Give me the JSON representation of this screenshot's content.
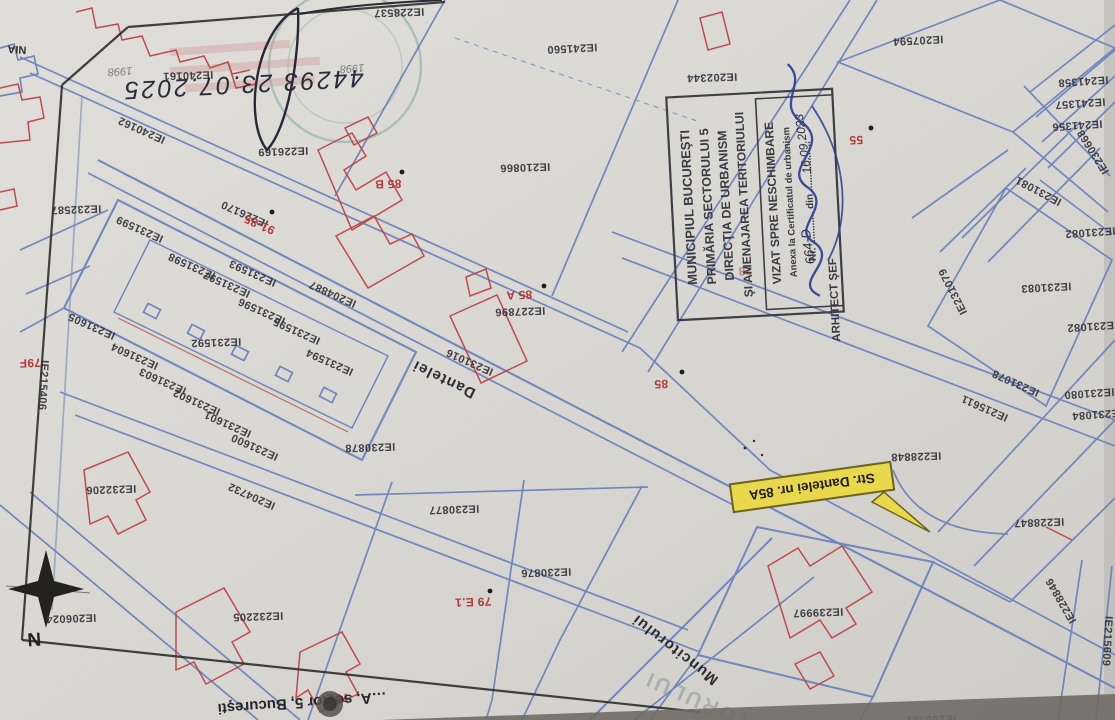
{
  "corner": {
    "text": "NIA"
  },
  "handwriting": {
    "registration": "44293   23.07.2025"
  },
  "faded": {
    "year_left": "1998",
    "year_right": "1998",
    "street_fragment": "TORULUI"
  },
  "compass": {
    "label": "N"
  },
  "footer": {
    "caption": "…A, sector 5, Bucureşti"
  },
  "callout": {
    "text": "Str. Dantelei nr. 85A",
    "fill": "#e9d84b"
  },
  "streets": {
    "dantelei": "Dantelei",
    "muncitorului": "Muncitorului"
  },
  "stamp": {
    "line1": "MUNICIPIUL BUCUREŞTI",
    "line2": "PRIMĂRIA SECTORULUI 5",
    "line3": "DIRECŢIA DE URBANISM",
    "line4": "ŞI AMENAJAREA TERITORIULUI",
    "box_title": "VIZAT SPRE NESCHIMBARE",
    "box_subtitle": "Anexa la Certificatul de urbanism",
    "number_line": "Nr. ............  din ..................",
    "handwritten_number": "664-D",
    "handwritten_date": "16.09.2023",
    "signer_title": "ARHITECT ŞEF"
  },
  "red_labels": [
    {
      "text": "85 B"
    },
    {
      "text": "85 A"
    },
    {
      "text": "85"
    },
    {
      "text": "55"
    },
    {
      "text": "91-85"
    },
    {
      "text": "79F"
    },
    {
      "text": "79 E.1"
    },
    {
      "text": "79E"
    },
    {
      "text": "28"
    }
  ],
  "parcel_ids": [
    {
      "id": "IE240161"
    },
    {
      "id": "IE240162"
    },
    {
      "id": "IE226169"
    },
    {
      "id": "IE228537"
    },
    {
      "id": "IE241560"
    },
    {
      "id": "IE202344"
    },
    {
      "id": "IE207594"
    },
    {
      "id": "IE241358"
    },
    {
      "id": "IE241357"
    },
    {
      "id": "IE241356"
    },
    {
      "id": "IE230668"
    },
    {
      "id": "IE231081"
    },
    {
      "id": "IE231082"
    },
    {
      "id": "IE231083"
    },
    {
      "id": "IE231082"
    },
    {
      "id": "IE231079"
    },
    {
      "id": "IE231078"
    },
    {
      "id": "IE215611"
    },
    {
      "id": "IE231080"
    },
    {
      "id": "IE231084"
    },
    {
      "id": "IE232587"
    },
    {
      "id": "IE226170"
    },
    {
      "id": "IE231599"
    },
    {
      "id": "IE231598"
    },
    {
      "id": "IE231597"
    },
    {
      "id": "IE231593"
    },
    {
      "id": "IE204887"
    },
    {
      "id": "IE231596"
    },
    {
      "id": "IE231595"
    },
    {
      "id": "IE231592"
    },
    {
      "id": "IE231594"
    },
    {
      "id": "IE231605"
    },
    {
      "id": "IE231604"
    },
    {
      "id": "IE231603"
    },
    {
      "id": "IE231602"
    },
    {
      "id": "IE231601"
    },
    {
      "id": "IE231600"
    },
    {
      "id": "IE215406"
    },
    {
      "id": "IE231016"
    },
    {
      "id": "IE227896"
    },
    {
      "id": "IE210866"
    },
    {
      "id": "IE230878"
    },
    {
      "id": "IE204732"
    },
    {
      "id": "IE230877"
    },
    {
      "id": "IE230876"
    },
    {
      "id": "IE232206"
    },
    {
      "id": "IE206024"
    },
    {
      "id": "IE232205"
    },
    {
      "id": "IE239997"
    },
    {
      "id": "IE228848"
    },
    {
      "id": "IE228847"
    },
    {
      "id": "IE228846"
    },
    {
      "id": "IE215609"
    },
    {
      "id": "IE205531"
    }
  ]
}
